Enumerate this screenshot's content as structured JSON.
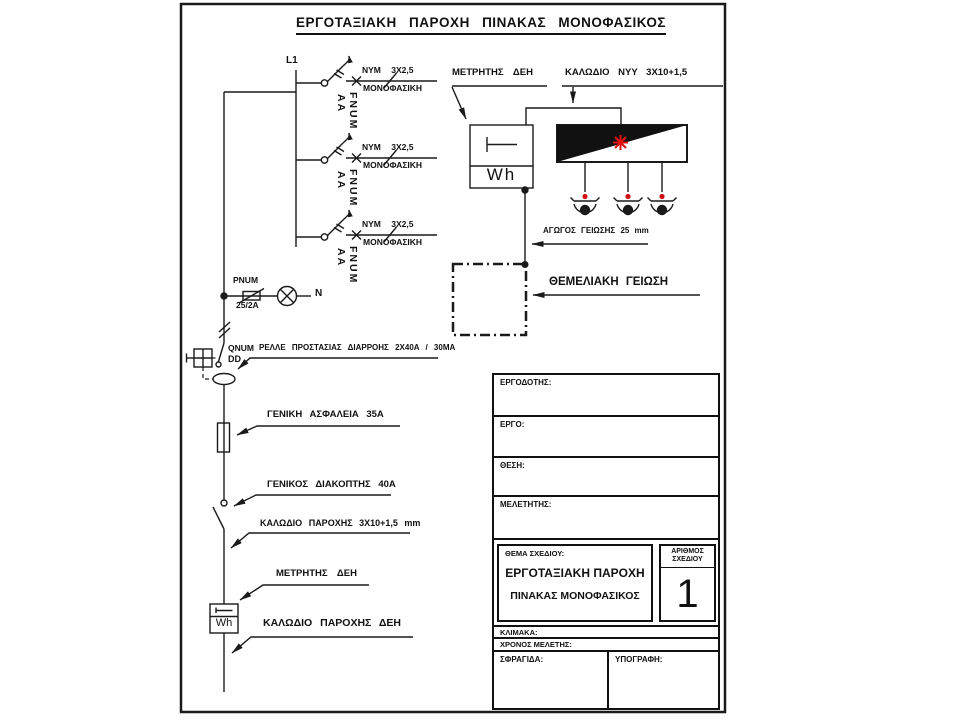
{
  "schematic": {
    "title": "ΕΡΓΟΤΑΞΙΑΚΗ ΠΑΡΟΧΗ ΠΙΝΑΚΑΣ ΜΟΝΟΦΑΣΙΚΟΣ",
    "phase": "L1",
    "neutral": "N",
    "branches": [
      {
        "cable": "NYM 3X2,5",
        "load": "ΜΟΝΟΦΑΣΙΚΗ",
        "device": "FNUM",
        "poles": "AA"
      },
      {
        "cable": "NYM 3X2,5",
        "load": "ΜΟΝΟΦΑΣΙΚΗ",
        "device": "FNUM",
        "poles": "AA"
      },
      {
        "cable": "NYM 3X2,5",
        "load": "ΜΟΝΟΦΑΣΙΚΗ",
        "device": "FNUM",
        "poles": "AA"
      }
    ],
    "pilot_fuse": {
      "name": "PNUM",
      "rating": "25/2A"
    },
    "rcd": {
      "name": "QNUM",
      "poles": "DD",
      "note": "ΡΕΛΛΕ ΠΡΟΣΤΑΣΙΑΣ ΔΙΑΡΡΟΗΣ 2X40A / 30MA"
    },
    "main_fuse": "ΓΕΝΙΚΗ ΑΣΦΑΛΕΙΑ 35A",
    "main_switch": "ΓΕΝΙΚΟΣ ΔΙΑΚΟΠΤΗΣ 40A",
    "supply_cable": "ΚΑΛΩΔΙΟ ΠΑΡΟΧΗΣ 3X10+1,5 mm",
    "meter": "ΜΕΤΡΗΤΗΣ ΔΕΗ",
    "meter_unit": "Wh",
    "utility_cable": "ΚΑΛΩΔΙΟ ΠΑΡΟΧΗΣ ΔΕΗ"
  },
  "site_panel": {
    "meter": "ΜΕΤΡΗΤΗΣ ΔΕΗ",
    "cable": "ΚΑΛΩΔΙΟ NYY 3X10+1,5",
    "meter_unit": "Wh",
    "ground_conductor": "ΑΓΩΓΟΣ ΓΕΙΩΣΗΣ 25 mm",
    "foundation_ground": "ΘΕΜΕΛΙΑΚΗ ΓΕΙΩΣΗ"
  },
  "title_block": {
    "employer": "ΕΡΓΟΔΟΤΗΣ:",
    "project": "ΕΡΓΟ:",
    "location": "ΘΕΣΗ:",
    "designer": "ΜΕΛΕΤΗΤΗΣ:",
    "subject_label": "ΘΕΜΑ ΣΧΕΔΙΟΥ:",
    "subject_line1": "ΕΡΓΟΤΑΞΙΑΚΗ ΠΑΡΟΧΗ",
    "subject_line2": "ΠΙΝΑΚΑΣ ΜΟΝΟΦΑΣΙΚΟΣ",
    "number_label_line1": "ΑΡΙΘΜΟΣ",
    "number_label_line2": "ΣΧΕΔΙΟΥ",
    "number": "1",
    "scale": "ΚΛΙΜΑΚΑ:",
    "study_time": "ΧΡΟΝΟΣ ΜΕΛΕΤΗΣ:",
    "stamp": "ΣΦΡΑΓΙΔΑ:",
    "signature": "ΥΠΟΓΡΑΦΗ:"
  },
  "colors": {
    "ink": "#1a1a1a",
    "red": "#dd1111"
  }
}
